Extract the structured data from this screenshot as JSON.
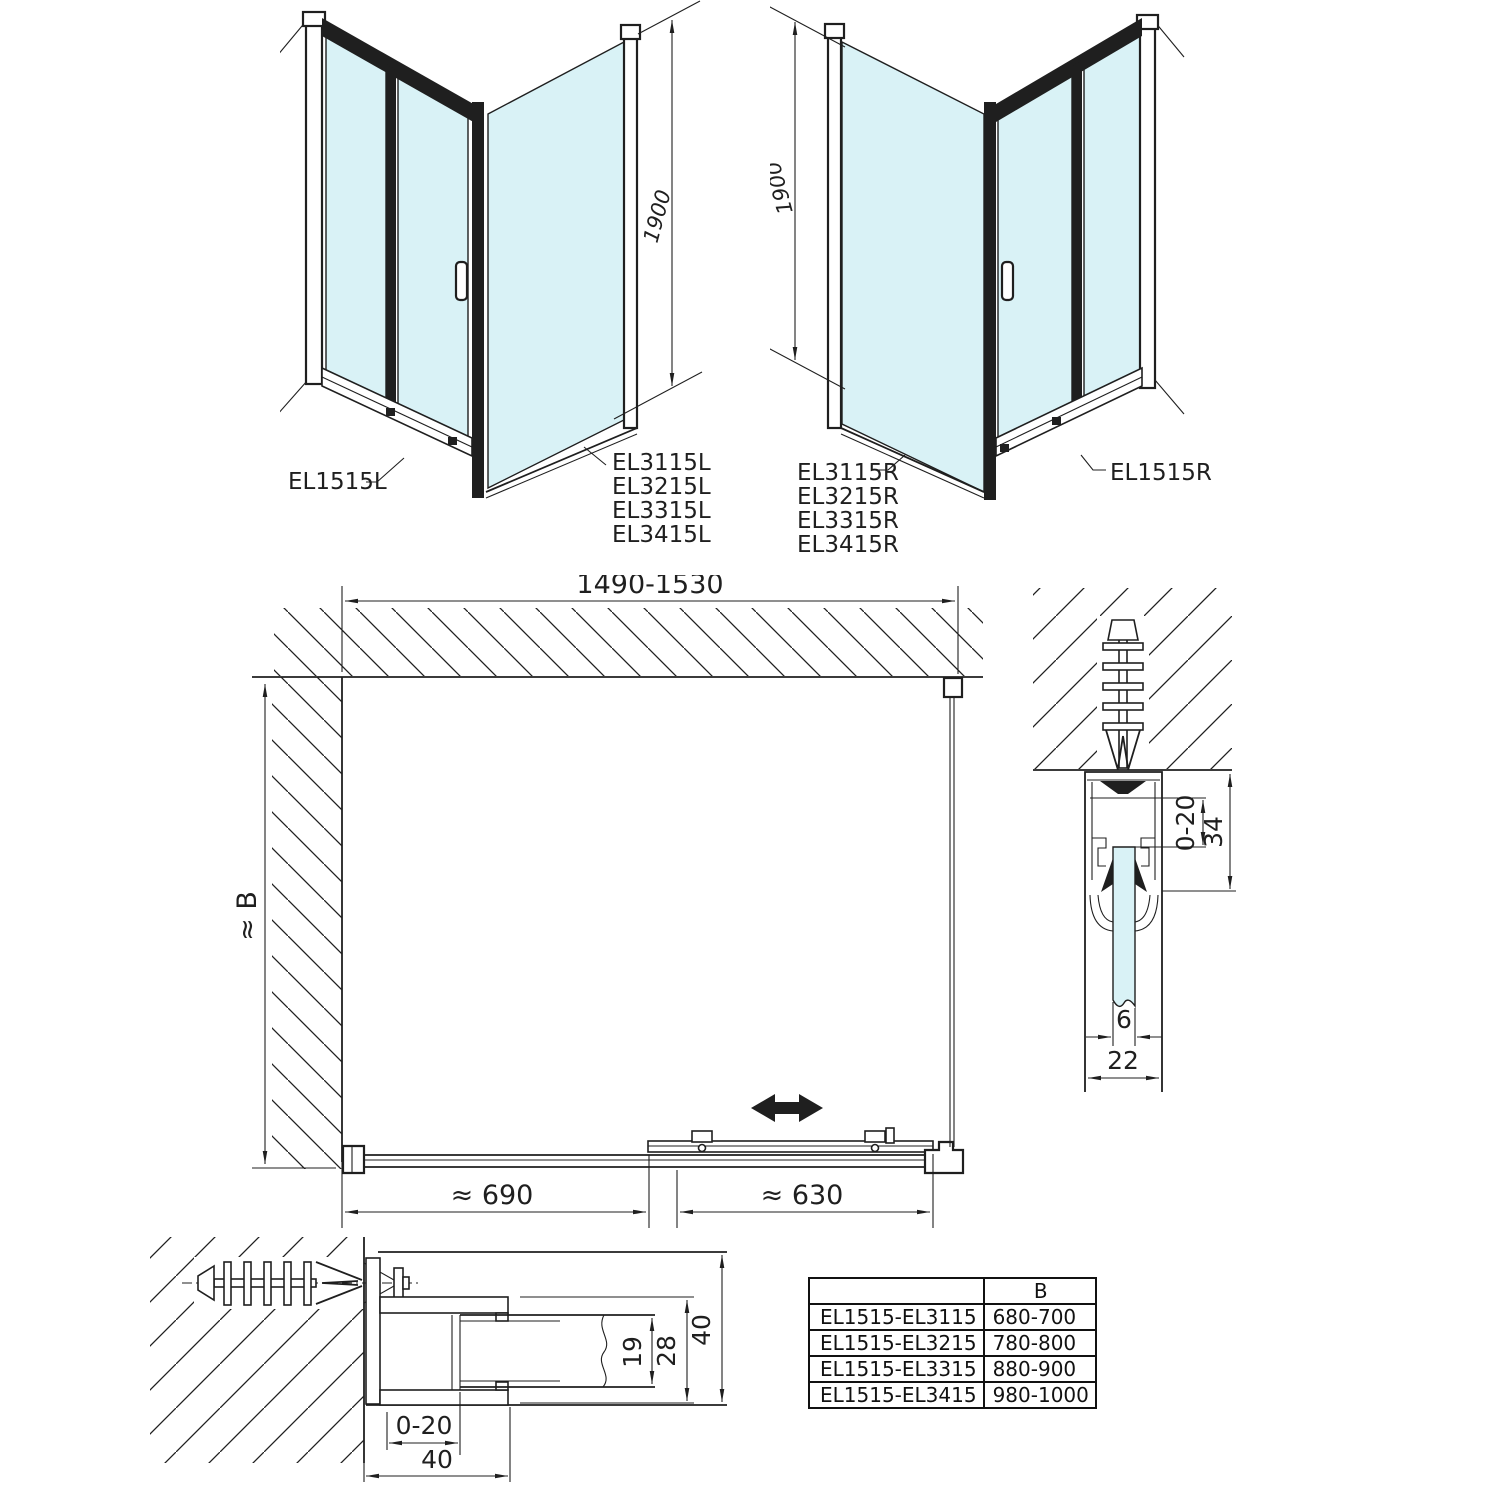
{
  "colors": {
    "line": "#1f1f1f",
    "glass": "#d9f2f6"
  },
  "iso_left": {
    "height_dim": "1900",
    "door_label": "EL1515L",
    "panel_labels": [
      "EL3115L",
      "EL3215L",
      "EL3315L",
      "EL3415L"
    ]
  },
  "iso_right": {
    "height_dim": "1900",
    "door_label": "EL1515R",
    "panel_labels": [
      "EL3115R",
      "EL3215R",
      "EL3315R",
      "EL3415R"
    ]
  },
  "plan": {
    "width_dim": "1490-1530",
    "depth_dim": "≈ B",
    "fixed_section_dim": "≈ 690",
    "sliding_section_dim": "≈ 630"
  },
  "wall_profile_section": {
    "adjust_dim": "0-20",
    "profile_depth_dim": "34",
    "glass_thickness_dim": "6",
    "profile_width_dim": "22"
  },
  "wall_profile_plan_section": {
    "glass_clamp_dim": "19",
    "channel_dim": "28",
    "profile_depth_dim": "40",
    "adjust_dim": "0-20",
    "profile_width_dim": "40"
  },
  "size_table": {
    "header_b": "B",
    "rows": [
      {
        "model": "EL1515-EL3115",
        "b": "680-700"
      },
      {
        "model": "EL1515-EL3215",
        "b": "780-800"
      },
      {
        "model": "EL1515-EL3315",
        "b": "880-900"
      },
      {
        "model": "EL1515-EL3415",
        "b": "980-1000"
      }
    ]
  }
}
